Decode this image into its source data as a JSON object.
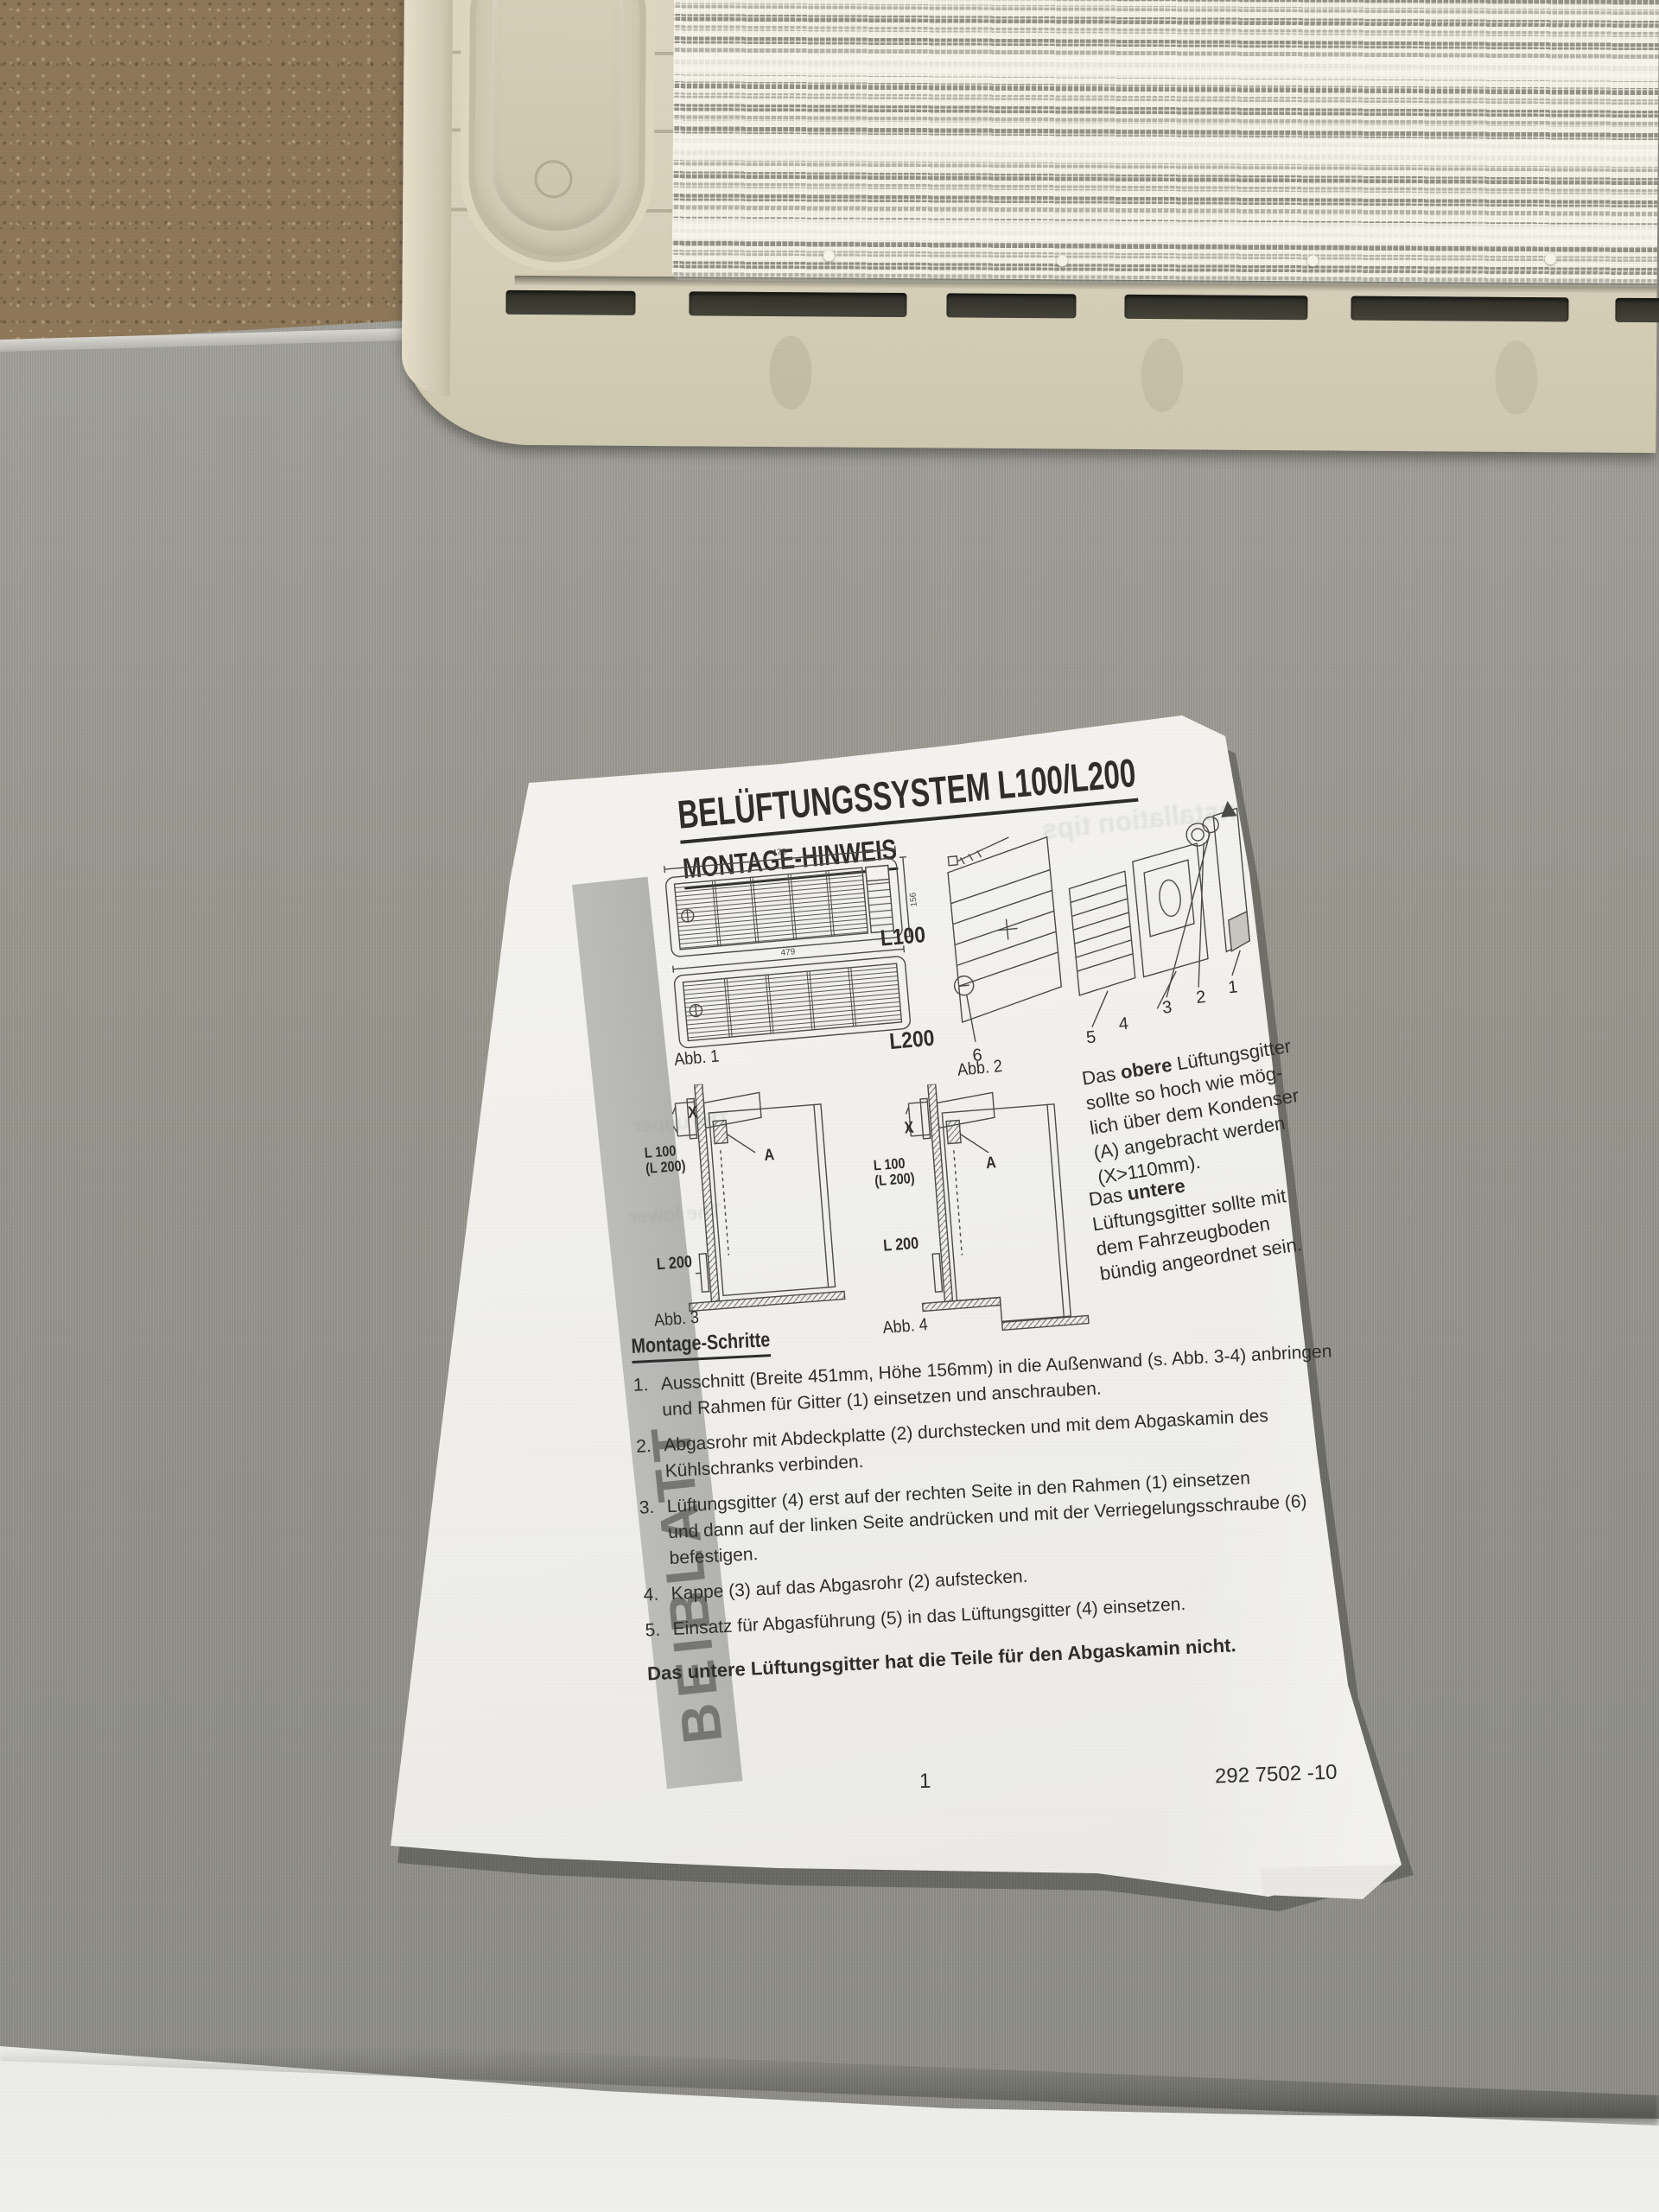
{
  "photo": {
    "surface_color": "#99988f",
    "floor_color": "#ebebe8",
    "cork_color": "#8d7758",
    "vent_color": "#d6cfb8",
    "mesh_color": "#efede0",
    "paper_color": "#f3f2ee",
    "stripe_color": "#b8b8b6"
  },
  "paper": {
    "stripe_label": "BEIBLATT",
    "header": {
      "title": "BELÜFTUNGSSYSTEM L100/L200",
      "subtitle": "MONTAGE-HINWEIS"
    },
    "fig1": {
      "caption": "Abb. 1",
      "label_top": "L100",
      "label_bottom": "L200",
      "dim_width": "479",
      "dim_height": "156"
    },
    "fig2": {
      "caption": "Abb. 2",
      "parts": [
        "6",
        "5",
        "4",
        "3",
        "2",
        "1"
      ]
    },
    "fig3": {
      "caption": "Abb. 3",
      "label_x": "X",
      "model": "L 100",
      "model2": "(L 200)",
      "label_a": "A",
      "lower": "L 200"
    },
    "fig4": {
      "caption": "Abb. 4",
      "label_x": "X",
      "model": "L 100",
      "model2": "(L 200)",
      "label_a": "A",
      "lower": "L 200"
    },
    "note_upper": {
      "pre": "Das ",
      "bold": "obere",
      "rest": " Lüftungsgitter",
      "lines": [
        "sollte so hoch wie mög-",
        "lich über dem Kondenser",
        "(A) angebracht werden",
        "(X>110mm)."
      ]
    },
    "note_lower": {
      "pre": "Das ",
      "bold": "untere",
      "lines": [
        "Lüftungsgitter sollte mit",
        "dem Fahrzeugboden",
        "bündig angeordnet sein."
      ]
    },
    "steps": {
      "heading": "Montage-Schritte",
      "items": [
        {
          "num": "1.",
          "lines": [
            "Ausschnitt (Breite 451mm, Höhe 156mm) in die Außenwand (s. Abb. 3-4) anbringen",
            "und Rahmen für Gitter (1) einsetzen und anschrauben."
          ]
        },
        {
          "num": "2.",
          "lines": [
            "Abgasrohr mit Abdeckplatte (2) durchstecken und mit dem Abgaskamin des",
            "Kühlschranks verbinden."
          ]
        },
        {
          "num": "3.",
          "lines": [
            "Lüftungsgitter (4) erst auf der rechten Seite in den Rahmen (1) einsetzen",
            "und dann auf der linken Seite andrücken und mit der Verriegelungsschraube (6)",
            "befestigen."
          ]
        },
        {
          "num": "4.",
          "lines": [
            "Kappe (3) auf das Abgasrohr (2) aufstecken."
          ]
        },
        {
          "num": "5.",
          "lines": [
            "Einsatz für Abgasführung (5) in das Lüftungsgitter (4) einsetzen."
          ]
        }
      ],
      "note": "Das untere Lüftungsgitter hat die Teile für den Abgaskamin nicht."
    },
    "footer": {
      "page": "1",
      "doc_number": "292 7502 -10"
    },
    "ghost": [
      "Installation tips",
      "The upper",
      "The lower"
    ]
  }
}
